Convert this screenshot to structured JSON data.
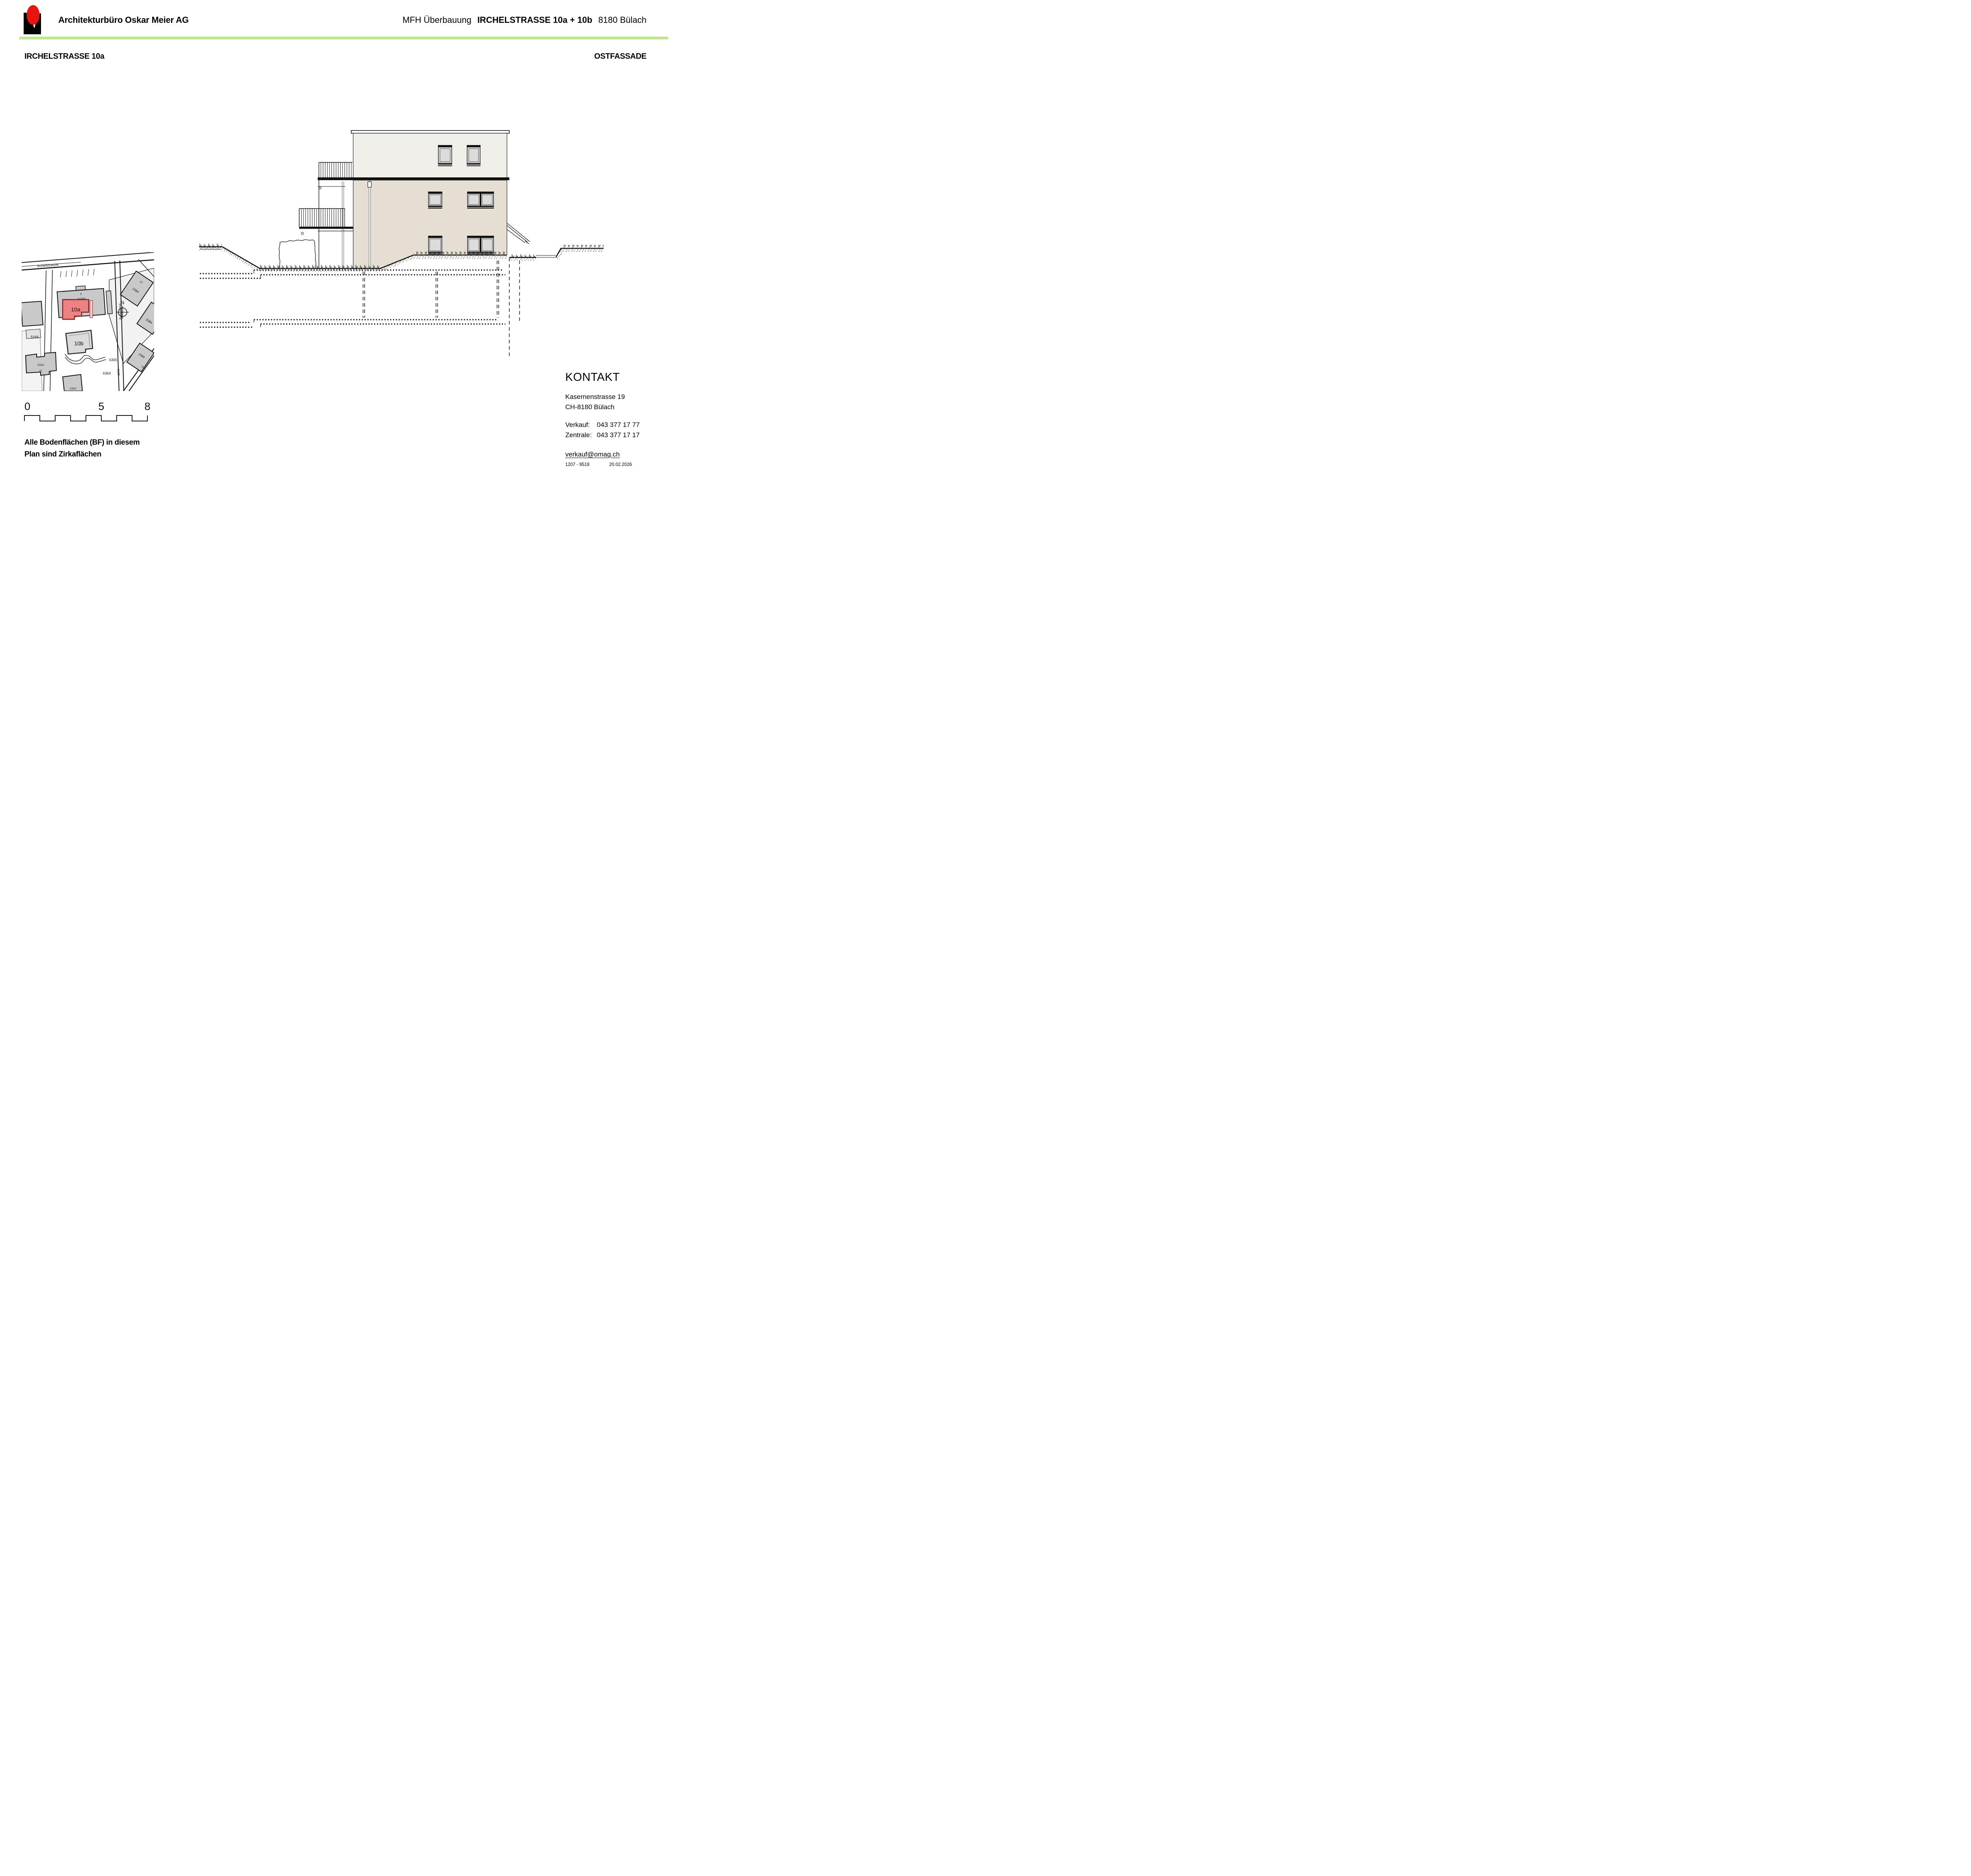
{
  "header": {
    "company": "Architekturbüro Oskar Meier AG",
    "project_prefix": "MFH Überbauung",
    "project_name": "IRCHELSTRASSE 10a + 10b",
    "project_city": "8180 Bülach"
  },
  "subheader": {
    "left": "IRCHELSTRASSE 10a",
    "right": "OSTFASSADE"
  },
  "site_plan": {
    "street_irchelstrasse": "Irchelstrasse",
    "street_irchelweg": "Irchelweg",
    "building_highlight": "10a",
    "building_b": "10b",
    "compass": "N",
    "parcels": {
      "p8": "8",
      "p2160": "2160",
      "p12": "12",
      "p2384a": "2384",
      "p14": "14",
      "p2384b": "2384",
      "p5166": "5166",
      "p6364": "6364",
      "p6365": "6365",
      "p5132": "5132",
      "p2389": "2389",
      "p27": "27",
      "p2314": "2314",
      "p37": "37",
      "p2310": "2310"
    }
  },
  "scale_bar": {
    "t0": "0",
    "t5": "5",
    "t8": "8"
  },
  "note": {
    "line1": "Alle Bodenflächen (BF) in diesem",
    "line2": "Plan sind Zirkaflächen"
  },
  "contact": {
    "title": "KONTAKT",
    "address1": "Kasernenstrasse 19",
    "address2": "CH-8180 Bülach",
    "sales_label": "Verkauf:",
    "sales_phone": "043 377 17 77",
    "central_label": "Zentrale:",
    "central_phone": "043 377 17 17",
    "email": "verkauf@omag.ch",
    "doc_number": "1207 - 9518",
    "date": "20.02.2026"
  },
  "colors": {
    "accent_green": "#bfe78f",
    "wall_main": "#e4ded3",
    "wall_attic": "#f1efea",
    "highlight_red": "#ee8282",
    "highlight_red_stroke": "#801d1d"
  }
}
